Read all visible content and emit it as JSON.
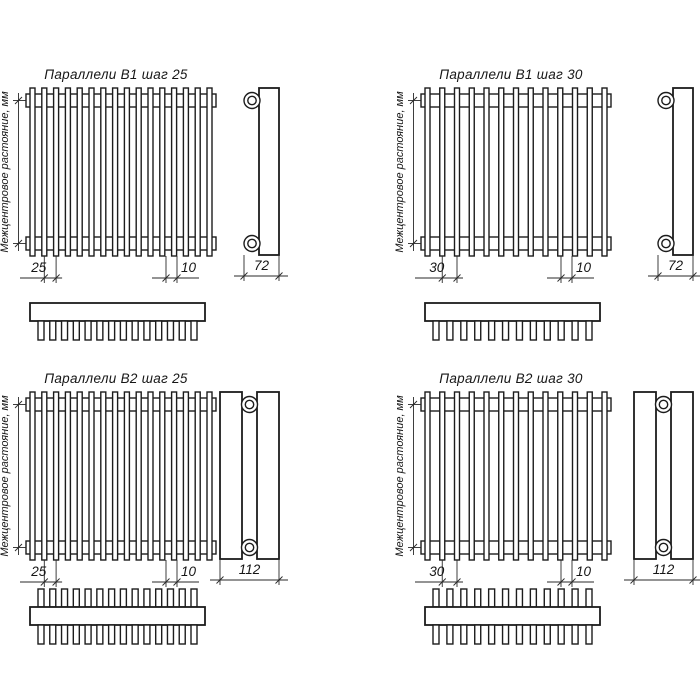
{
  "labels": {
    "intercenter": "Межцентровое растояние, мм"
  },
  "diagrams": [
    {
      "title": "Параллели В1 шаг 25",
      "type": "B1",
      "step": "25",
      "end": "10",
      "depth": "72",
      "front_tubes": 16,
      "top_teeth": 14
    },
    {
      "title": "Параллели В1 шаг 30",
      "type": "B1",
      "step": "30",
      "end": "10",
      "depth": "72",
      "front_tubes": 13,
      "top_teeth": 12
    },
    {
      "title": "Параллели В2 шаг 25",
      "type": "B2",
      "step": "25",
      "end": "10",
      "depth": "112",
      "front_tubes": 16,
      "top_teeth": 14
    },
    {
      "title": "Параллели В2 шаг 30",
      "type": "B2",
      "step": "30",
      "end": "10",
      "depth": "112",
      "front_tubes": 13,
      "top_teeth": 12
    }
  ],
  "colors": {
    "line": "#1c1c1c",
    "dim": "#2a2a2a",
    "background": "#ffffff"
  }
}
